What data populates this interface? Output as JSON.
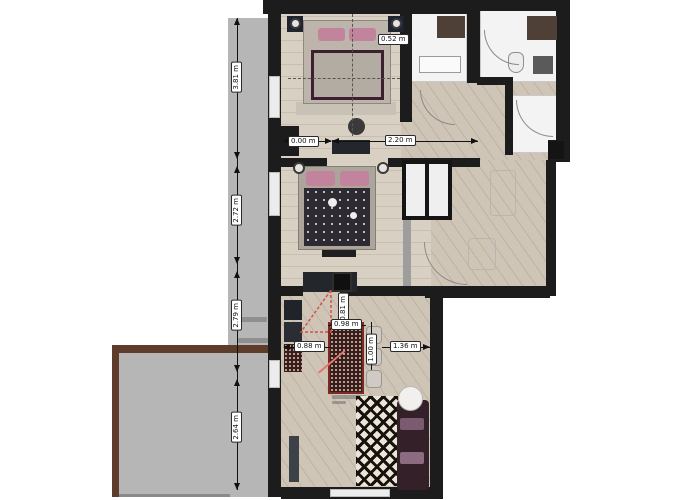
{
  "plan": {
    "type": "apartment-floor-plan",
    "unit": "m",
    "labels": {
      "left_vertical": [
        "3.81 m",
        "2.72 m",
        "2.79 m",
        "2.64 m"
      ],
      "closet_width": "0.52 m",
      "hall_short": "0.00 m",
      "hall_long": "2.20 m",
      "kitchen_top_vertical": "0.81 m",
      "kitchen_top": "0.98 m",
      "kitchen_left": "0.88 m",
      "kitchen_right_vertical": "1.00 m",
      "kitchen_right": "1.36 m"
    },
    "colors": {
      "wall": "#1c1c1c",
      "partition": "#9e9e9e",
      "balcony_gray": "#b6b6b6",
      "terrace_border_brown": "#5d3c2b",
      "wood_floor": "#d3c9bb",
      "bathroom_floor": "#f3f3f3",
      "accent_red": "#d05248",
      "pillow_pink": "#c2849c",
      "sofa_plum": "#342028"
    }
  }
}
